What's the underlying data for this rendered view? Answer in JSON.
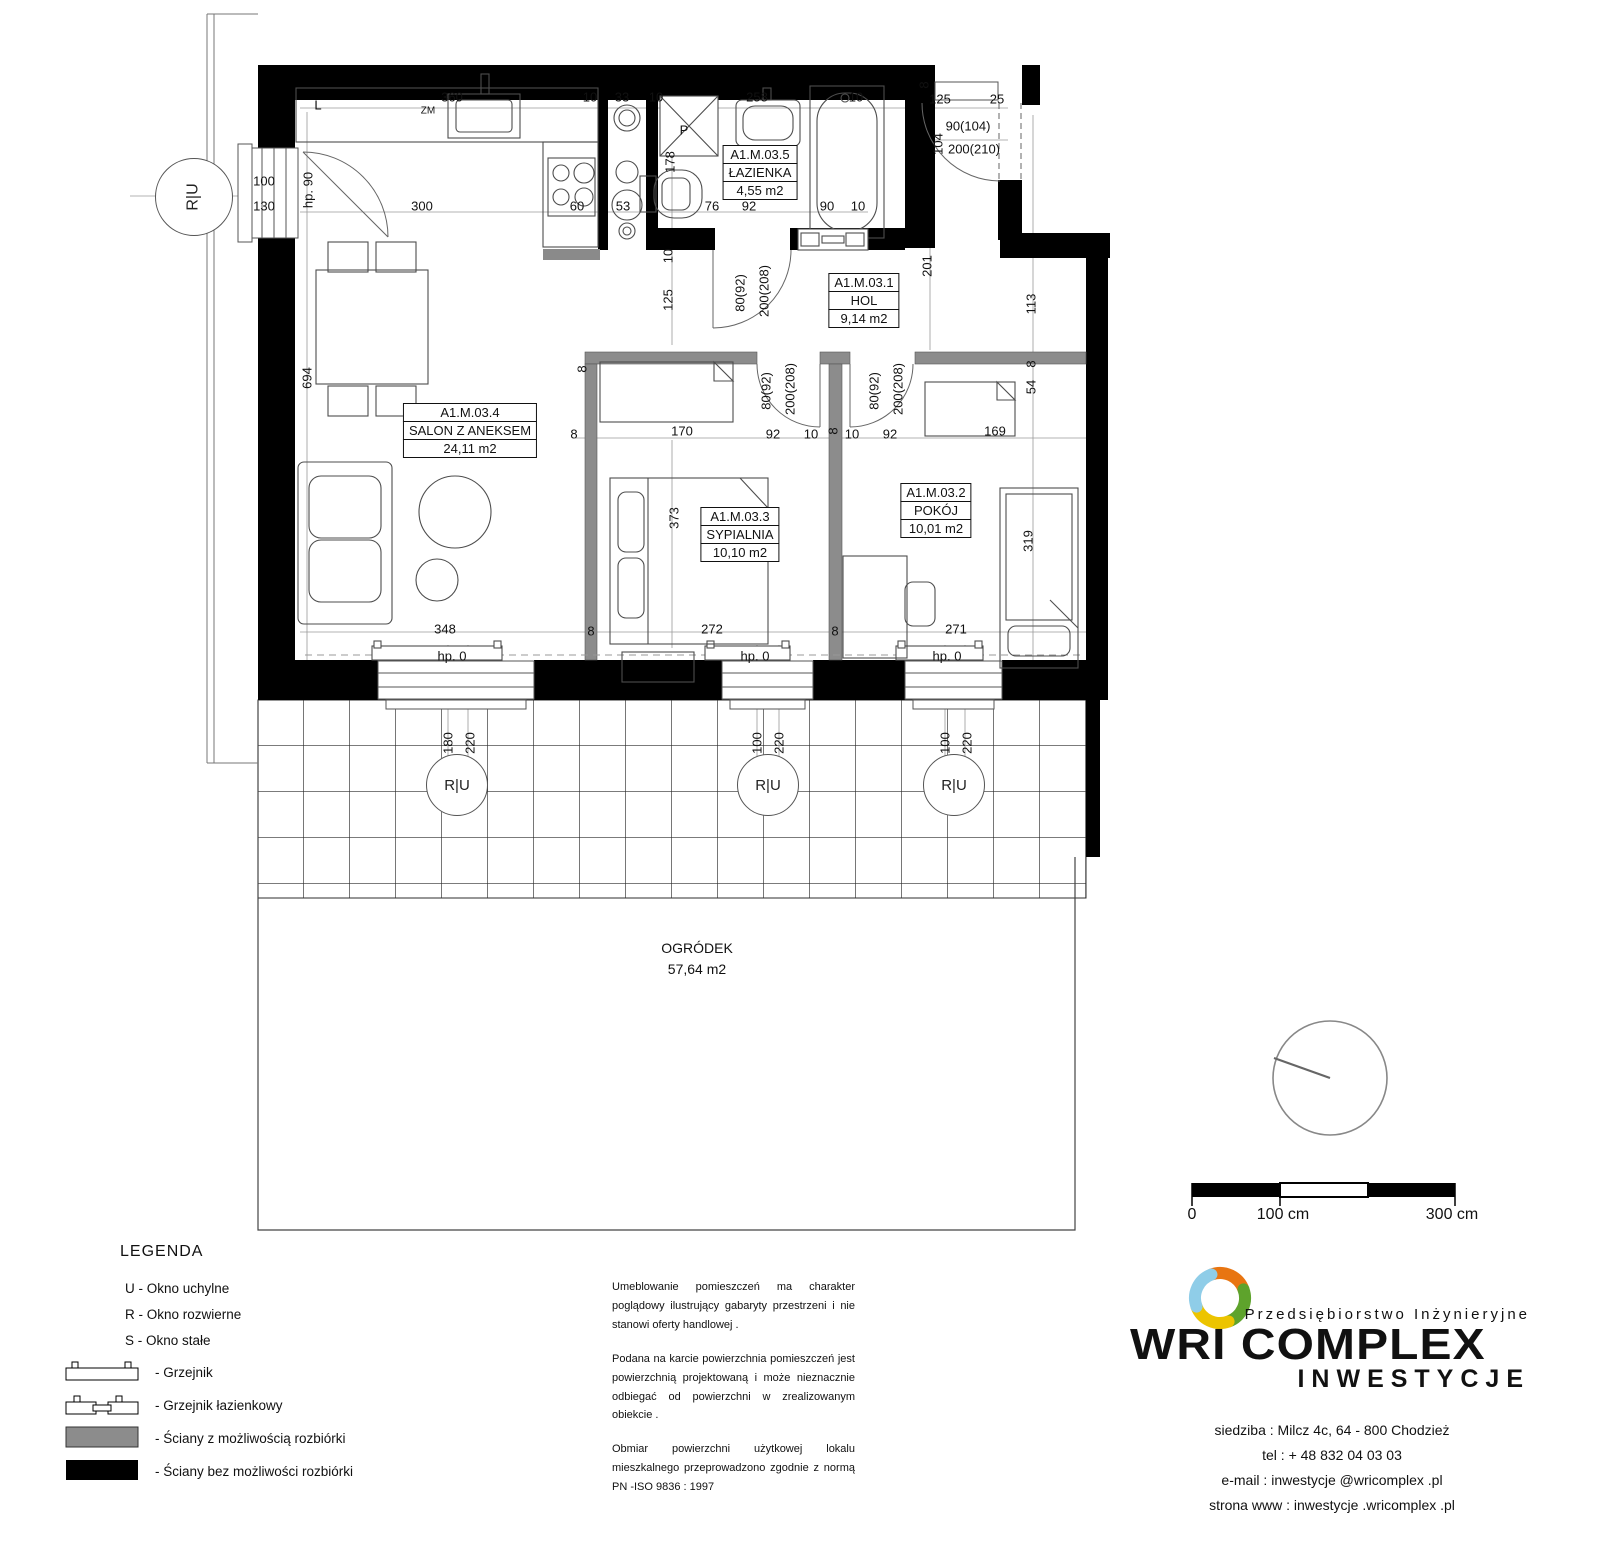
{
  "plan": {
    "rooms": [
      {
        "id": "A1.M.03.5",
        "name": "ŁAZIENKA",
        "area": "4,55 m2",
        "x": 760,
        "y": 146
      },
      {
        "id": "A1.M.03.1",
        "name": "HOL",
        "area": "9,14 m2",
        "x": 864,
        "y": 274
      },
      {
        "id": "A1.M.03.4",
        "name": "SALON Z ANEKSEM",
        "area": "24,11 m2",
        "x": 470,
        "y": 404
      },
      {
        "id": "A1.M.03.3",
        "name": "SYPIALNIA",
        "area": "10,10 m2",
        "x": 740,
        "y": 508
      },
      {
        "id": "A1.M.03.2",
        "name": "POKÓJ",
        "area": "10,01 m2",
        "x": 936,
        "y": 484
      }
    ],
    "garden": {
      "name": "OGRÓDEK",
      "area": "57,64 m2"
    },
    "markers": [
      {
        "label": "R|U",
        "x": 193,
        "y": 196,
        "big": 1,
        "rot": 1
      },
      {
        "label": "R|U",
        "x": 456,
        "y": 784
      },
      {
        "label": "R|U",
        "x": 767,
        "y": 784
      },
      {
        "label": "R|U",
        "x": 953,
        "y": 784
      }
    ],
    "dimensions": [
      {
        "t": "L",
        "x": 318,
        "y": 105
      },
      {
        "t": "ZM",
        "x": 428,
        "y": 111,
        "s": 1
      },
      {
        "t": "360",
        "x": 452,
        "y": 97
      },
      {
        "t": "10",
        "x": 590,
        "y": 97
      },
      {
        "t": "33",
        "x": 622,
        "y": 97
      },
      {
        "t": "10",
        "x": 656,
        "y": 97
      },
      {
        "t": "258",
        "x": 757,
        "y": 97
      },
      {
        "t": "10",
        "x": 856,
        "y": 97
      },
      {
        "t": "8",
        "x": 924,
        "y": 85,
        "r": 1
      },
      {
        "t": "125",
        "x": 940,
        "y": 99
      },
      {
        "t": "25",
        "x": 997,
        "y": 99
      },
      {
        "t": "90(104)",
        "x": 968,
        "y": 126
      },
      {
        "t": "104",
        "x": 938,
        "y": 144,
        "r": 1
      },
      {
        "t": "200(210)",
        "x": 974,
        "y": 149
      },
      {
        "t": "100",
        "x": 264,
        "y": 181
      },
      {
        "t": "130",
        "x": 264,
        "y": 206
      },
      {
        "t": "hp. 90",
        "x": 308,
        "y": 190,
        "r": 1
      },
      {
        "t": "300",
        "x": 422,
        "y": 206
      },
      {
        "t": "60",
        "x": 577,
        "y": 206
      },
      {
        "t": "53",
        "x": 623,
        "y": 206
      },
      {
        "t": "178",
        "x": 670,
        "y": 162,
        "r": 1
      },
      {
        "t": "76",
        "x": 712,
        "y": 206
      },
      {
        "t": "92",
        "x": 749,
        "y": 206
      },
      {
        "t": "90",
        "x": 827,
        "y": 206
      },
      {
        "t": "10",
        "x": 858,
        "y": 206
      },
      {
        "t": "P",
        "x": 684,
        "y": 130
      },
      {
        "t": "10",
        "x": 668,
        "y": 256,
        "r": 1
      },
      {
        "t": "125",
        "x": 668,
        "y": 300,
        "r": 1
      },
      {
        "t": "80(92)",
        "x": 740,
        "y": 293,
        "r": 1
      },
      {
        "t": "200(208)",
        "x": 764,
        "y": 291,
        "r": 1
      },
      {
        "t": "201",
        "x": 927,
        "y": 266,
        "r": 1
      },
      {
        "t": "113",
        "x": 1031,
        "y": 304,
        "r": 1
      },
      {
        "t": "694",
        "x": 307,
        "y": 378,
        "r": 1
      },
      {
        "t": "8",
        "x": 582,
        "y": 369,
        "r": 1
      },
      {
        "t": "8",
        "x": 574,
        "y": 434
      },
      {
        "t": "170",
        "x": 682,
        "y": 431
      },
      {
        "t": "92",
        "x": 773,
        "y": 434
      },
      {
        "t": "10",
        "x": 811,
        "y": 434
      },
      {
        "t": "8",
        "x": 833,
        "y": 431,
        "r": 1
      },
      {
        "t": "10",
        "x": 852,
        "y": 434
      },
      {
        "t": "92",
        "x": 890,
        "y": 434
      },
      {
        "t": "169",
        "x": 995,
        "y": 431
      },
      {
        "t": "8",
        "x": 1031,
        "y": 364,
        "r": 1
      },
      {
        "t": "54",
        "x": 1031,
        "y": 387,
        "r": 1
      },
      {
        "t": "80(92)",
        "x": 766,
        "y": 391,
        "r": 1
      },
      {
        "t": "200(208)",
        "x": 790,
        "y": 389,
        "r": 1
      },
      {
        "t": "80(92)",
        "x": 874,
        "y": 391,
        "r": 1
      },
      {
        "t": "200(208)",
        "x": 898,
        "y": 389,
        "r": 1
      },
      {
        "t": "373",
        "x": 674,
        "y": 518,
        "r": 1
      },
      {
        "t": "319",
        "x": 1028,
        "y": 541,
        "r": 1
      },
      {
        "t": "348",
        "x": 445,
        "y": 629
      },
      {
        "t": "8",
        "x": 591,
        "y": 631
      },
      {
        "t": "272",
        "x": 712,
        "y": 629
      },
      {
        "t": "8",
        "x": 835,
        "y": 631
      },
      {
        "t": "271",
        "x": 956,
        "y": 629
      },
      {
        "t": "hp. 0",
        "x": 452,
        "y": 656
      },
      {
        "t": "hp. 0",
        "x": 755,
        "y": 656
      },
      {
        "t": "hp. 0",
        "x": 947,
        "y": 656
      },
      {
        "t": "180",
        "x": 448,
        "y": 743,
        "r": 1
      },
      {
        "t": "220",
        "x": 470,
        "y": 743,
        "r": 1
      },
      {
        "t": "100",
        "x": 757,
        "y": 743,
        "r": 1
      },
      {
        "t": "220",
        "x": 779,
        "y": 743,
        "r": 1
      },
      {
        "t": "100",
        "x": 945,
        "y": 743,
        "r": 1
      },
      {
        "t": "220",
        "x": 967,
        "y": 743,
        "r": 1
      }
    ],
    "scale_bar": {
      "start": "0",
      "mid": "100 cm",
      "end": "300 cm"
    }
  },
  "legend": {
    "title": "LEGENDA",
    "window_types": [
      {
        "key": "U",
        "label": "Okno uchylne"
      },
      {
        "key": "R",
        "label": "Okno rozwierne"
      },
      {
        "key": "S",
        "label": "Okno stałe"
      }
    ],
    "symbols": [
      {
        "type": "radiator",
        "label": "Grzejnik"
      },
      {
        "type": "radiator-bath",
        "label": "Grzejnik łazienkowy"
      },
      {
        "type": "wall-gray",
        "label": "Ściany z możliwością rozbiórki"
      },
      {
        "type": "wall-black",
        "label": "Ściany bez możliwości rozbiórki"
      }
    ]
  },
  "notes": [
    "Umeblowanie pomieszczeń ma charakter poglądowy ilustrujący gabaryty przestrzeni i nie stanowi oferty handlowej .",
    "Podana na karcie powierzchnia pomieszczeń jest powierzchnią projektowaną i może nieznacznie odbiegać od powierzchni w zrealizowanym obiekcie .",
    "Obmiar powierzchni użytkowej lokalu mieszkalnego przeprowadzono zgodnie z normą PN -ISO 9836 : 1997"
  ],
  "company": {
    "tagline": "Przedsiębiorstwo Inżynieryjne",
    "name": "WRI COMPLEX",
    "subname": "INWESTYCJE",
    "contact": [
      "siedziba : Milcz 4c, 64 - 800 Chodzież",
      "tel : + 48 832 04 03 03",
      "e-mail : inwestycje @wricomplex .pl",
      "strona www : inwestycje .wricomplex .pl"
    ]
  },
  "colors": {
    "wall_solid": "#000000",
    "wall_removable": "#8c8c8c",
    "logo_orange": "#e87511",
    "logo_green": "#5ea32c",
    "logo_yellow": "#ecc400",
    "logo_blue": "#8fcde8"
  }
}
